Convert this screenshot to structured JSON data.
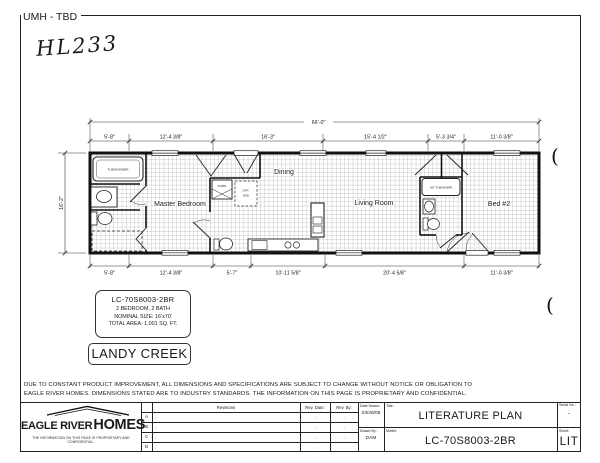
{
  "page": {
    "header_label": "UMH - TBD",
    "handwritten_note": "HL233",
    "pen_mark": "("
  },
  "plan": {
    "overall_width": "66'-0\"",
    "left_height": "16'-2\"",
    "dims_top": [
      "5'-8\"",
      "12'-4 3/8\"",
      "16'-3\"",
      "15'-4 1/2\"",
      "5'-3 3/4\"",
      "11'-0 3/8\""
    ],
    "dims_bottom": [
      "5'-8\"",
      "12'-4 3/8\"",
      "5'-7\"",
      "10'-11 5/8\"",
      "20'-4 5/8\"",
      "11'-0 3/8\""
    ],
    "rooms": {
      "master_bedroom": "Master Bedroom",
      "dining": "Dining",
      "living_room": "Living Room",
      "bed2": "Bed #2"
    },
    "fixtures": {
      "tub_master": "TUB/SHOWER",
      "tub_bath2": "60\" TUB/SHWR",
      "furnace": "FURN",
      "opt_wd_1": "OPT.",
      "opt_wd_2": "W/D"
    }
  },
  "model_box": {
    "model": "LC-70S8003-2BR",
    "beds_baths": "2 BEDROOM, 2 BATH",
    "nominal_size": "NOMINAL SIZE: 16'x70'",
    "total_area": "TOTAL AREA: 1,001 SQ. FT."
  },
  "series_box": {
    "name": "LANDY CREEK"
  },
  "disclaimer": {
    "line1": "DUE TO CONSTANT PRODUCT IMPROVEMENT, ALL DIMENSIONS AND SPECIFICATIONS ARE SUBJECT TO CHANGE WITHOUT NOTICE OR OBLIGATION TO",
    "line2": "EAGLE RIVER HOMES. DIMENSIONS STATED ARE TO INDUSTRY STANDARDS. THE INFORMATION ON THIS PAGE IS PROPRIETARY AND CONFIDENTIAL."
  },
  "titleblock": {
    "logo": {
      "name1": "EAGLE RIVER",
      "name2": "HOMES",
      "tagline": "THE INFORMATION ON THIS PAGE IS PROPRIETARY AND CONFIDENTIAL."
    },
    "revisions": {
      "header": "Revisions",
      "rev_date_header": "Rev. Date:",
      "rev_by_header": "Rev. By:",
      "colon": ":",
      "rows": [
        {
          "letter": "A"
        },
        {
          "letter": "B"
        },
        {
          "letter": "C"
        },
        {
          "letter": "D"
        }
      ]
    },
    "fields": {
      "date_drawn_label": "Date Drawn:",
      "date_drawn": "03/28/05",
      "drawn_by_label": "Drawn By:",
      "drawn_by": "DAM",
      "title_label": "Title:",
      "title": "LITERATURE PLAN",
      "model_label": "Model:",
      "model": "LC-70S8003-2BR",
      "serial_label": "Serial No.:",
      "serial": "-",
      "sheet_label": "Sheet:",
      "sheet": "LIT"
    }
  }
}
